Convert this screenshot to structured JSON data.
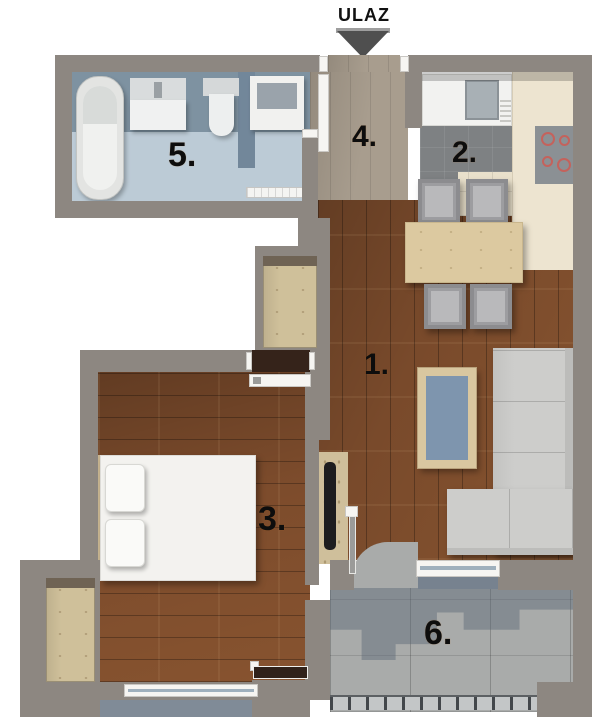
{
  "entrance": {
    "label": "ULAZ"
  },
  "rooms": {
    "living_room": {
      "number": "1."
    },
    "kitchen": {
      "number": "2."
    },
    "bedroom": {
      "number": "3."
    },
    "hallway": {
      "number": "4."
    },
    "bathroom": {
      "number": "5."
    },
    "terrace": {
      "number": "6."
    }
  },
  "palette": {
    "wall": "#8d8781",
    "wood_floor": "#794a2b",
    "hallway_floor": "#a89d8e",
    "bathroom_floor": "#bccbd6",
    "bathroom_wall_tile": "#7e92a1",
    "kitchen_tile_cream": "#e9e0cb",
    "kitchen_tile_gray": "#7e8183",
    "terrace_concrete": "#a9abaa",
    "terrace_shadow": "#586575",
    "door_frame": "#f6f5f2",
    "plywood": "#cfc09a",
    "label_text": "#0d0d0d",
    "arrow": "#4f4f4f"
  }
}
